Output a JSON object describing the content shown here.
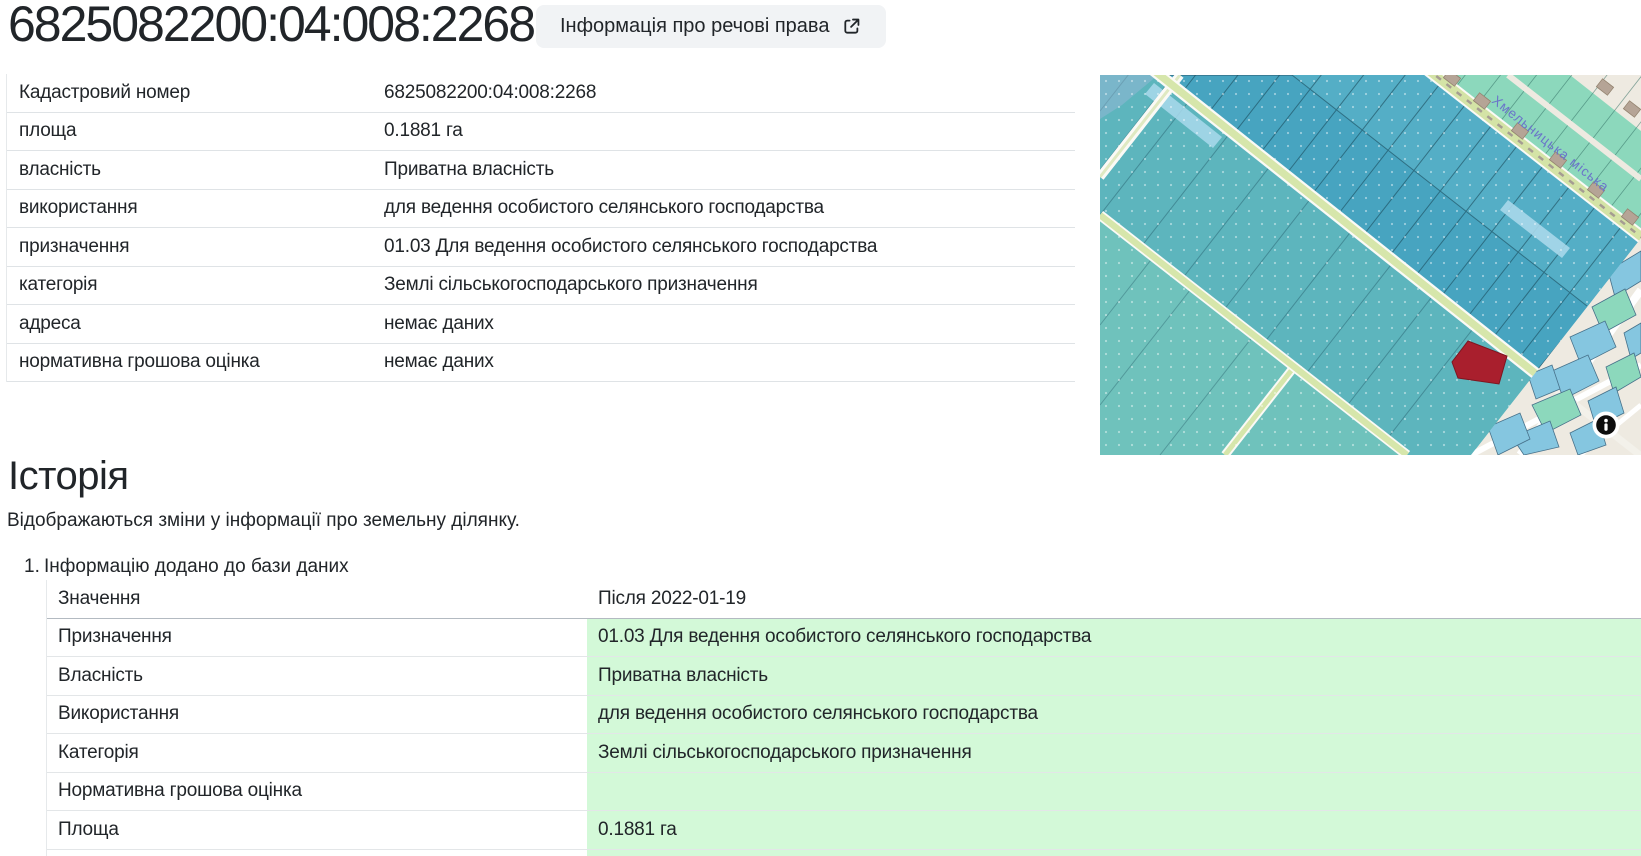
{
  "header": {
    "cadastral_number": "6825082200:04:008:2268",
    "rights_button_label": "Інформація про речові права"
  },
  "parcel_table": {
    "rows": [
      {
        "label": "Кадастровий номер",
        "value": "6825082200:04:008:2268"
      },
      {
        "label": "площа",
        "value": "0.1881 га"
      },
      {
        "label": "власність",
        "value": "Приватна власність"
      },
      {
        "label": "використання",
        "value": "для ведення особистого селянського господарства"
      },
      {
        "label": "призначення",
        "value": "01.03 Для ведення особистого селянського господарства"
      },
      {
        "label": "категорія",
        "value": "Землі сільськогосподарського призначення"
      },
      {
        "label": "адреса",
        "value": "немає даних"
      },
      {
        "label": "нормативна грошова оцінка",
        "value": "немає даних"
      }
    ]
  },
  "map": {
    "street_label": "Хмельницька міська",
    "highlight_color": "#a91f2d"
  },
  "history": {
    "title": "Історія",
    "subtitle": "Відображаються зміни у інформації про земельну ділянку.",
    "highlight_color": "#d3f9d8",
    "entries": [
      {
        "index": "1.",
        "title": "Інформацію додано до бази даних",
        "value_header": "Значення",
        "date_header": "Після 2022-01-19",
        "rows": [
          {
            "label": "Призначення",
            "value": "01.03 Для ведення особистого селянського господарства"
          },
          {
            "label": "Власність",
            "value": "Приватна власність"
          },
          {
            "label": "Використання",
            "value": "для ведення особистого селянського господарства"
          },
          {
            "label": "Категорія",
            "value": "Землі сільськогосподарського призначення"
          },
          {
            "label": "Нормативна грошова оцінка",
            "value": ""
          },
          {
            "label": "Площа",
            "value": "0.1881 га"
          }
        ]
      }
    ]
  }
}
